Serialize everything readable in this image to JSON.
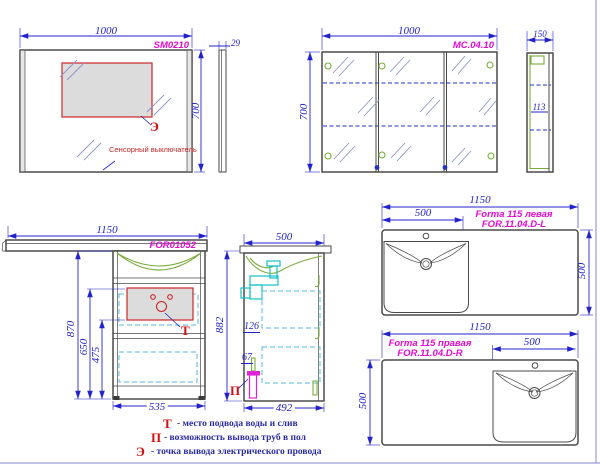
{
  "mirror": {
    "code": "SM0210",
    "width": "1000",
    "height": "700",
    "depth": "29",
    "electric_marker": "Э",
    "sensor_label": "Сенсорный выключатель"
  },
  "mirror_cabinet": {
    "code": "MC.04.10",
    "width": "1000",
    "height": "700",
    "depth": "150",
    "inner_depth": "113"
  },
  "vanity": {
    "code": "FOR01052",
    "countertop_width": "1150",
    "height": "870",
    "dim_650": "650",
    "dim_475": "475",
    "body_width": "535",
    "water_marker": "Т"
  },
  "vanity_side": {
    "depth": "500",
    "height": "882",
    "siphon_dim": "126",
    "pipe_dim": "67",
    "bottom_depth": "492",
    "floor_marker": "П"
  },
  "washbasin_left": {
    "title": "Forma 115 левая",
    "code": "FOR.11.04.D-L",
    "width": "1150",
    "bowl_width": "500",
    "depth": "500"
  },
  "washbasin_right": {
    "title": "Forma 115 правая",
    "code": "FOR.11.04.D-R",
    "width": "1150",
    "bowl_width": "500",
    "depth": "500"
  },
  "legend": [
    {
      "marker": "Т",
      "text": "- место подвода воды и слив"
    },
    {
      "marker": "П",
      "text": "- возможность вывода труб в пол"
    },
    {
      "marker": "Э",
      "text": "- точка вывода электрического провода"
    }
  ],
  "colors": {
    "dimension": "#2323cc",
    "model_code": "#e50ad2",
    "marker_red": "#d40f0f",
    "outline": "#4a4a4a",
    "accent_green": "#79ac3a",
    "accent_cyan": "#55b9e0",
    "pipe_magenta": "#e322d8",
    "legend_text": "#2a2aa8",
    "page_frame": "#9a9ad0"
  }
}
